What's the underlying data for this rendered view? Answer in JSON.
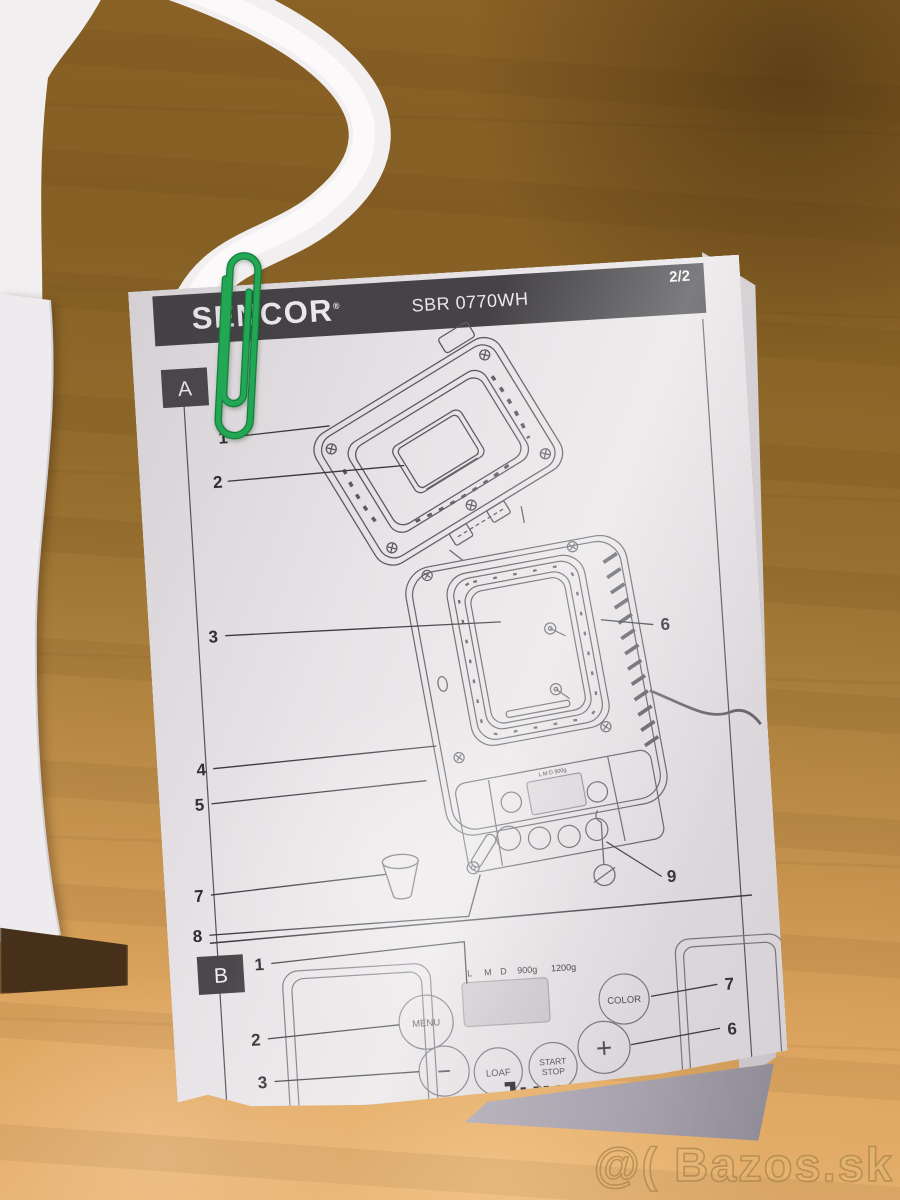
{
  "photo": {
    "watermark": "@( Bazos.sk"
  },
  "header": {
    "brand": "SENCOR",
    "registered": "®",
    "model": "SBR 0770WH",
    "page_indicator": "2/2"
  },
  "section_a": {
    "label": "A",
    "callouts": {
      "n1": "1",
      "n2": "2",
      "n3": "3",
      "n4": "4",
      "n5": "5",
      "n6": "6",
      "n7": "7",
      "n8": "8",
      "n9": "9"
    },
    "machine_mini_label": "L M D 900g"
  },
  "section_b": {
    "label": "B",
    "callouts": {
      "n1": "1",
      "n2": "2",
      "n3": "3",
      "n6": "6",
      "n7": "7"
    },
    "display": {
      "sizes": [
        "L",
        "M",
        "D"
      ],
      "weights": [
        "900g",
        "1200g"
      ]
    },
    "buttons": {
      "menu": "MENU",
      "color": "COLOR",
      "loaf": "LOAF",
      "start": "START",
      "stop": "STOP",
      "minus": "−",
      "plus": "+"
    },
    "cut_text_fragment": ".. Juu."
  },
  "colors": {
    "paper": "#e8e4e7",
    "ink": "#2e2d31",
    "header_bar": "#454346",
    "paperclip_green": "#1f9e4f",
    "wood": "#a87a3a"
  }
}
